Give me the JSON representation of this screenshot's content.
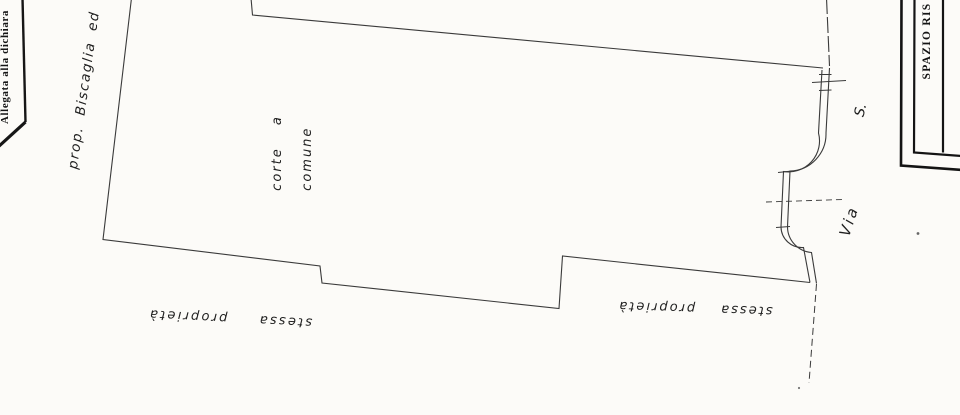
{
  "page": {
    "background": "#fcfbf8",
    "thin_line_color": "#3a3a3a",
    "border_line_color": "#161616",
    "ink_color": "#1f1f1f"
  },
  "form": {
    "left_header": "Allegata alla dichiara",
    "corner_box_label": "SPAZIO RIS"
  },
  "plan": {
    "labels": {
      "neighbor_property": "prop. Biscaglia ed",
      "courtyard_line1": "corte a",
      "courtyard_line2": "comune",
      "same_property_left": "stessa proprietà",
      "same_property_right": "stessa proprietà",
      "street_word": "Via",
      "street_initial": "S."
    }
  }
}
